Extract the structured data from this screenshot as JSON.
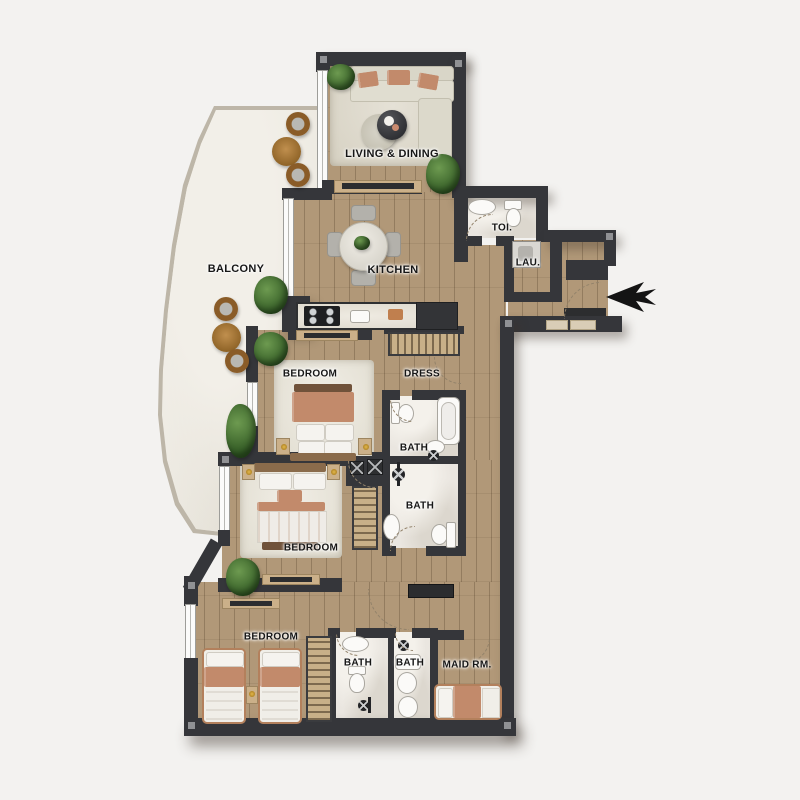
{
  "plan": {
    "title": "apartment-floor-plan",
    "labels": {
      "living": "LIVING & DINING",
      "balcony": "BALCONY",
      "kitchen": "KITCHEN",
      "toilet": "TOI.",
      "laundry": "LAU.",
      "dress": "DRESS",
      "bedroom_1": "BEDROOM",
      "bedroom_2": "BEDROOM",
      "bedroom_3": "BEDROOM",
      "bath_1": "BATH",
      "bath_2": "BATH",
      "bath_3": "BATH",
      "bath_4": "BATH",
      "maid_room": "MAID RM."
    },
    "entry": {
      "arrow_direction": "left"
    },
    "colors": {
      "bg": "#f3f2f0",
      "wall": "#35363a",
      "wood": "#b19878",
      "woodline": "#937c5f",
      "balconyfloor": "#edeae2",
      "marble": "#eae6e0",
      "rug": "#ece9e0",
      "terracotta": "#c28a6b",
      "sofa": "#d9d6c8",
      "furnwood": "#cbb089",
      "plant": "#4d7c3c",
      "gold": "#c9972f",
      "text": "#161616"
    }
  }
}
